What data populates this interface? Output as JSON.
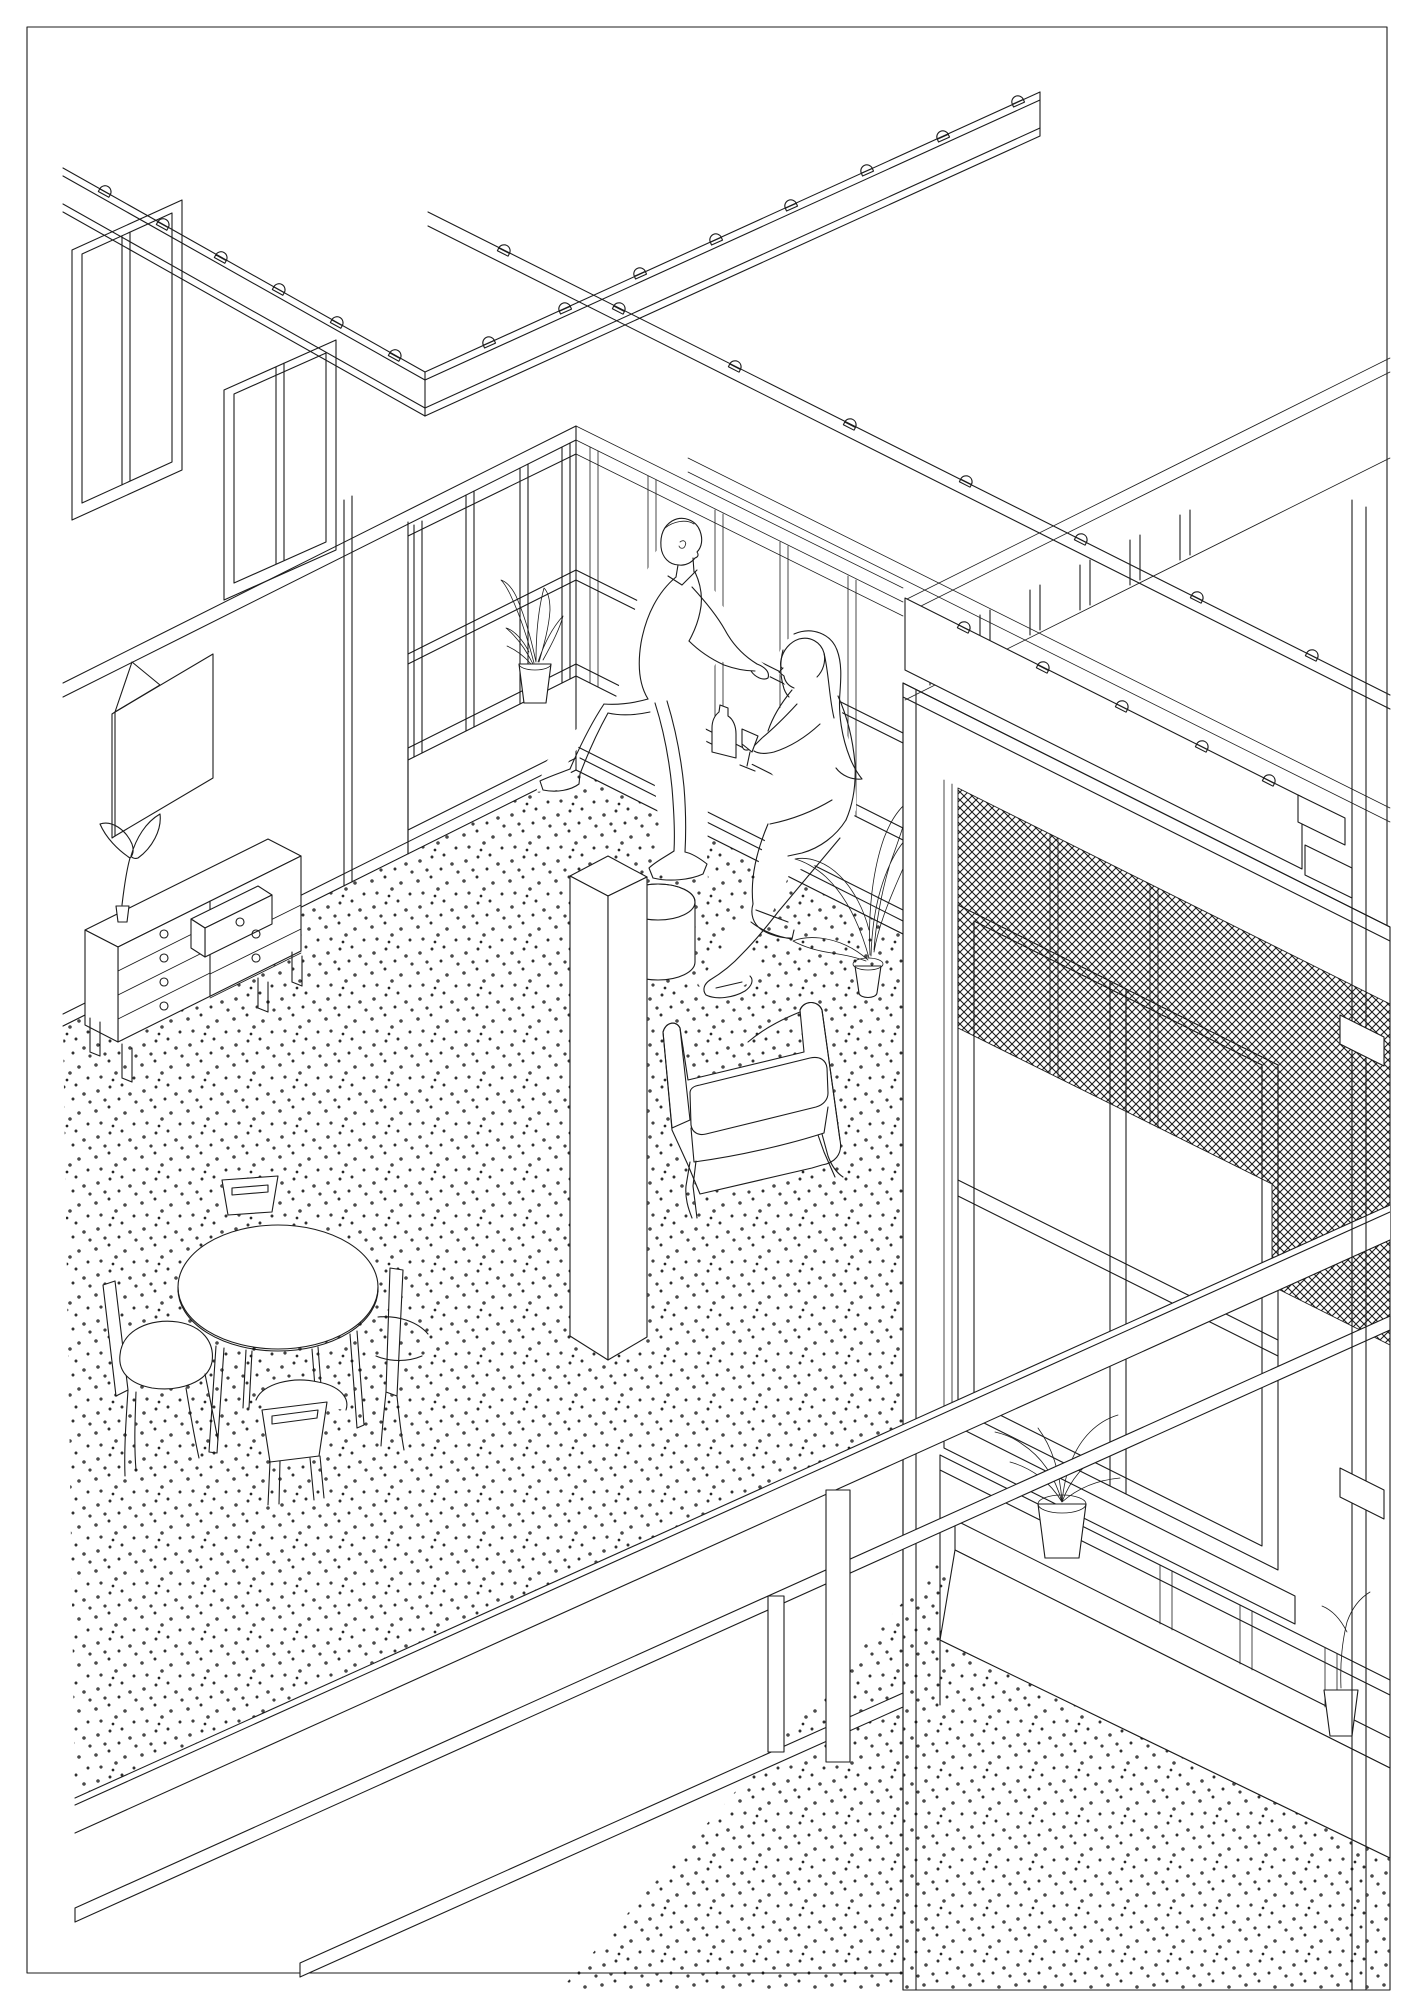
{
  "page": {
    "background": "#ffffff",
    "line_color": "#1c1c1c",
    "border_color": "#000000",
    "dot_color": "#2a2a2a"
  },
  "drawing": {
    "style": "black-and-white axonometric architectural line drawing",
    "view": "cutaway of an upper-storey communal room at a building corner, with a sectioned facade and balcony at right and the lower storey visible below the floor slab",
    "elements": {
      "roof_parapet": {
        "description": "V-shaped roof parapet band with evenly spaced fixing clips",
        "clips_left_arm": 6,
        "clips_right_arm": 8
      },
      "right_wing_parapet": {
        "description": "long parapet band of right wing sloping down to the right",
        "clips": 8
      },
      "clerestory_windows": {
        "count": 2,
        "description": "tall mullioned windows of the rear wing seen above the left wall"
      },
      "left_wall": {
        "features": [
          "corner glazing with paired mullions",
          "solid wall with hung poster",
          "baseboard"
        ]
      },
      "window_wall": {
        "description": "fully glazed wall with continuous window-seat bench",
        "mullion_bays": 5,
        "mid_rail": true
      },
      "poster_frame": {
        "shape": "square sheet pinned to wall, top-left corner folded over"
      },
      "dresser": {
        "drawers_left_column": 4,
        "drawers_right_column": 3,
        "open_drawer": "top-right drawer pulled out",
        "knobs": 7,
        "legs": 4,
        "top_item": "small two-leaf plant in pot"
      },
      "dining_table": {
        "shape": "round top with thick edge",
        "legs": 4,
        "chairs": 4,
        "chair_back": "curved with horizontal slot"
      },
      "column": {
        "shape": "free-standing square column from floor toward ceiling"
      },
      "ottoman": {
        "shape": "round drum pouf behind the column"
      },
      "armchair": {
        "description": "upholstered lounge armchair with loose seat cushion and thin splayed legs, facing left"
      },
      "people": {
        "man": {
          "pose": "perched on window-seat edge, legs stretched to floor, arms resting on glazing rail, facing right toward woman"
        },
        "woman": {
          "pose": "sitting on window seat facing left, long hair, holding stemmed glass, wearing sandals",
          "props": [
            "wine bottle on bench",
            "stemmed glass"
          ]
        }
      },
      "plants": [
        {
          "name": "snake plant",
          "location": "window-seat bench near corner"
        },
        {
          "name": "broad-leaf plant in pot",
          "location": "floor beside window seat"
        },
        {
          "name": "two-leaf plant in small pot",
          "location": "dresser top"
        },
        {
          "name": "spider plant in pot",
          "location": "lower-storey window sill"
        },
        {
          "name": "seedling in pot",
          "location": "lower-storey window sill, right"
        }
      ],
      "floor": {
        "texture": "stippled random-dot floor finish"
      },
      "facade_section": {
        "description": "sectioned facade slab at right",
        "parts": [
          "balcony fascia beam with fixing clips",
          "balustrade posts and rails",
          "crosshatched insect-mesh roller screen",
          "large four-pane window with deep frame",
          "projecting window sill",
          "edge column with brackets"
        ]
      },
      "floor_slab": {
        "description": "diagonal floor-slab edge band separating the two storeys"
      },
      "lower_storey": {
        "parts": [
          "long edge beams",
          "two support posts",
          "window with three mullions",
          "window sill with plants",
          "stippled floor"
        ]
      }
    }
  }
}
